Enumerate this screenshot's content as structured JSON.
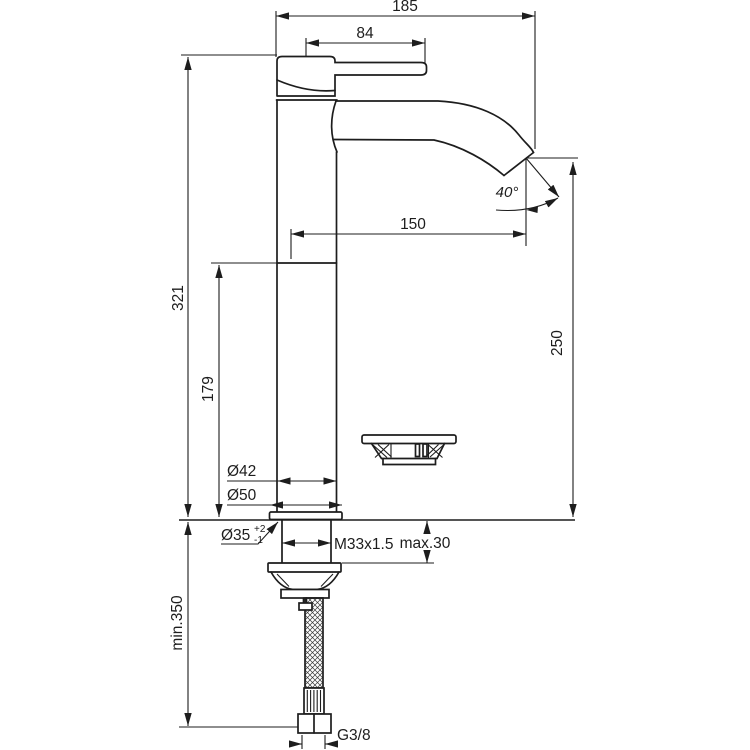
{
  "drawing": {
    "description": "Technical dimension drawing of a tall single-lever basin mixer tap with flexible supply hose and drain plug part",
    "units": "mm",
    "colors": {
      "line": "#1d1d1d",
      "background": "#ffffff"
    },
    "labels": {
      "overall_width": "185",
      "handle_length": "84",
      "spout_reach": "150",
      "spout_angle": "40°",
      "height_total": "321",
      "height_body": "179",
      "height_outlet": "250",
      "dia_body": "Ø42",
      "dia_base": "Ø50",
      "dia_hole": "Ø35",
      "dia_hole_tol_plus": "+2",
      "dia_hole_tol_minus": "-1",
      "thread": "M33x1.5",
      "deck_thickness_max": "max.30",
      "hose_length_min": "min.350",
      "hose_connection": "G3/8"
    }
  }
}
